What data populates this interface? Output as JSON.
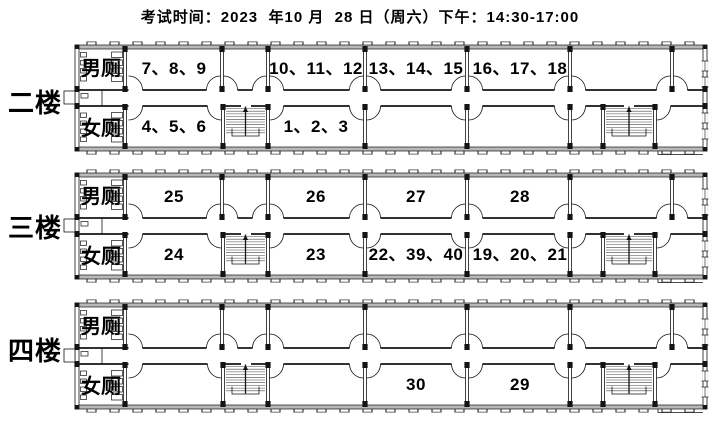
{
  "title": "考试时间：2023  年10 月  28 日（周六）下午：14:30-17:00",
  "floors": [
    {
      "name": "二楼",
      "mens_toilet": "男厕",
      "womens_toilet": "女厕",
      "top_rooms": [
        "7、8、9",
        "10、11、12",
        "13、14、15",
        "16、17、18"
      ],
      "bottom_rooms": [
        "4、5、6",
        "1、2、3",
        "",
        ""
      ]
    },
    {
      "name": "三楼",
      "mens_toilet": "男厕",
      "womens_toilet": "女厕",
      "top_rooms": [
        "25",
        "26",
        "27",
        "28"
      ],
      "bottom_rooms": [
        "24",
        "23",
        "22、39、40",
        "19、20、21"
      ]
    },
    {
      "name": "四楼",
      "mens_toilet": "男厕",
      "womens_toilet": "女厕",
      "top_rooms": [
        "",
        "",
        "",
        ""
      ],
      "bottom_rooms": [
        "",
        "",
        "30",
        "29"
      ]
    }
  ],
  "colors": {
    "wall": "#141414",
    "wall_fill": "#b8b8b8",
    "text": "#000000",
    "background": "#ffffff"
  }
}
